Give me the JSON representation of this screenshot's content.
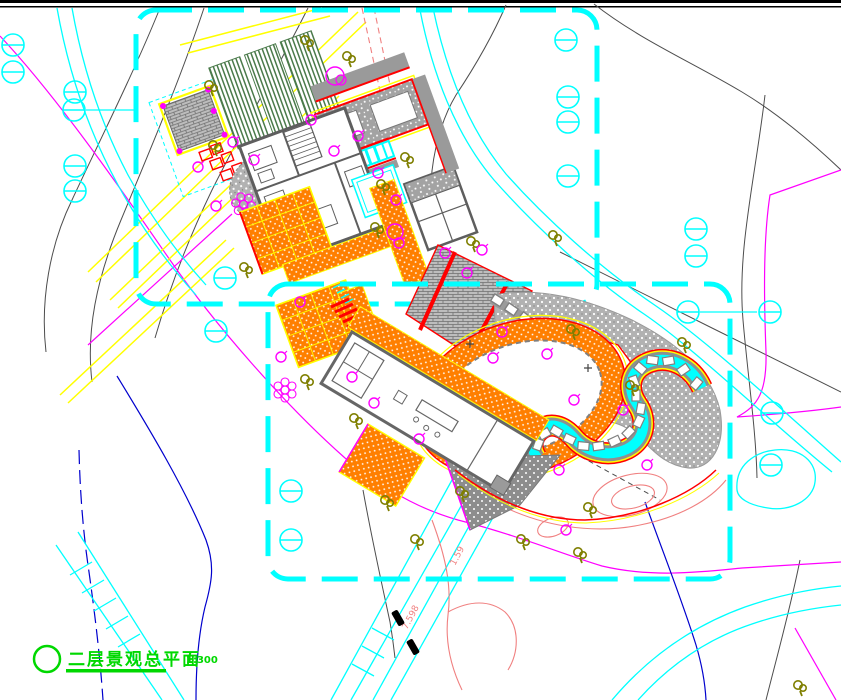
{
  "title_block": {
    "drawing_title": "二层景观总平面",
    "scale_label": "1:300"
  },
  "annotations": {
    "elevation_labels": [
      "7.598",
      "1.59",
      "7.598"
    ]
  },
  "symbols": {
    "existing_tree": "cyan-circle-tree-icon",
    "small_tree": "olive-tree-icon",
    "shrub": "magenta-shrub-icon",
    "flower_bed": "magenta-flower-icon",
    "car": "car-glyph"
  },
  "colors": {
    "cyan": "#00ffff",
    "magenta": "#ff00ff",
    "yellow": "#ffff00",
    "orange": "#ff7f00",
    "red": "#ff0000",
    "salmon": "#f08080",
    "blue": "#0000cd",
    "olive": "#7f7f00",
    "green-title": "#00d800",
    "green-dark": "#4a7a4a",
    "gray-line": "#4d4d4d",
    "gray-mid": "#9e9e9e",
    "gray-dark": "#8a8a8a",
    "ink": "#000000"
  }
}
